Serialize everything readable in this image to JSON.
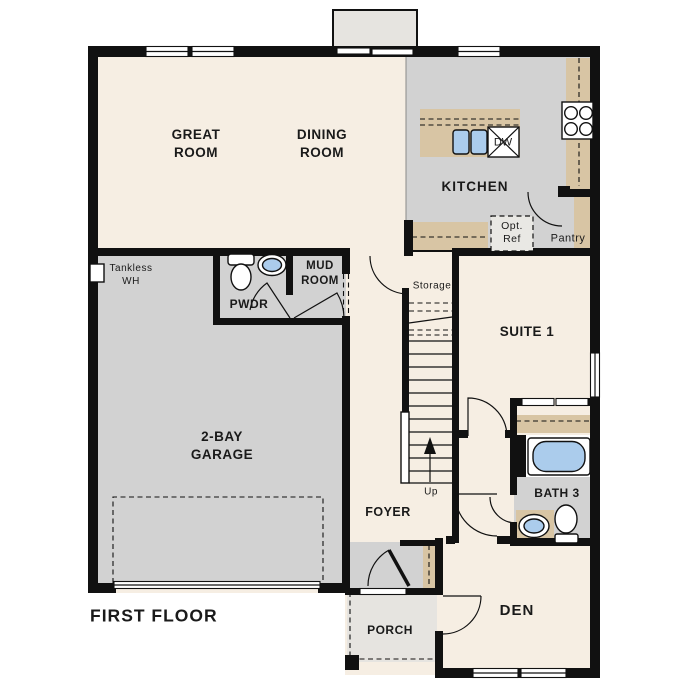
{
  "palette": {
    "wall": "#111111",
    "room_cream": "#f6eee3",
    "room_gray": "#d2d2d2",
    "room_light": "#e6e4e0",
    "counter_tan": "#d8c5a4",
    "fixture_blue": "#abccec",
    "background": "#ffffff",
    "text": "#1a1a1a"
  },
  "title": "FIRST FLOOR",
  "rooms": {
    "great_room": "GREAT\nROOM",
    "dining_room": "DINING\nROOM",
    "kitchen": "KITCHEN",
    "pantry": "Pantry",
    "mud_room": "MUD\nROOM",
    "powder_room": "PWDR",
    "garage": "2-BAY\nGARAGE",
    "foyer": "FOYER",
    "suite_1": "SUITE 1",
    "bath_3": "BATH 3",
    "den": "DEN",
    "porch": "PORCH",
    "storage": "Storage"
  },
  "annotations": {
    "tankless_water_heater": "Tankless\nWH",
    "optional_refrigerator": "Opt.\nRef",
    "dishwasher": "DW",
    "stairs_direction": "Up"
  }
}
